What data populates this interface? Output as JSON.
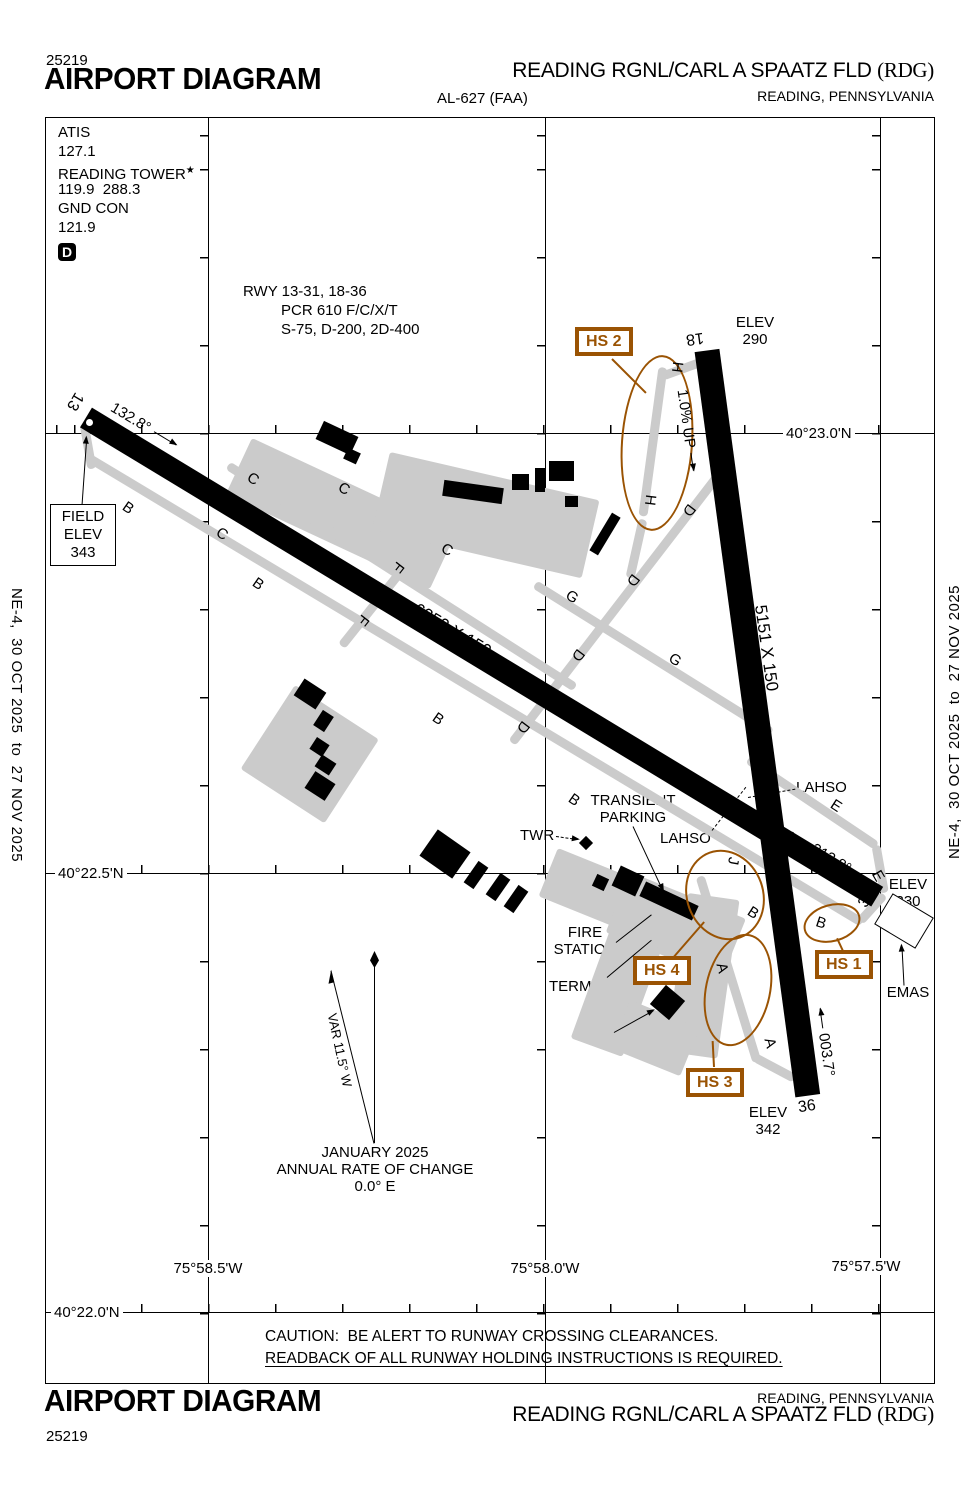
{
  "doc": {
    "chart_number": "25219",
    "title": "AIRPORT DIAGRAM",
    "al_number": "AL-627 (FAA)",
    "airport_name": "READING RGNL/CARL A SPAATZ FLD",
    "airport_code": "(RDG)",
    "city": "READING, PENNSYLVANIA",
    "side_text": "NE-4,  30 OCT 2025  to  27 NOV 2025"
  },
  "comm": {
    "atis_label": "ATIS",
    "atis_freq": "127.1",
    "tower_label": "READING TOWER",
    "tower_star": "★",
    "tower_freq": "119.9  288.3",
    "gnd_label": "GND CON",
    "gnd_freq": "121.9",
    "d_badge": "D"
  },
  "rwy_info": {
    "line1": "RWY 13-31, 18-36",
    "line2": "PCR 610 F/C/X/T",
    "line3": "S-75, D-200, 2D-400"
  },
  "grid": {
    "lat1": "40°23.0'N",
    "lat2": "40°22.5'N",
    "lat3": "40°22.0'N",
    "lon1": "75°58.5'W",
    "lon2": "75°58.0'W",
    "lon3": "75°57.5'W"
  },
  "rwy1331": {
    "num1": "13",
    "num2": "31",
    "dim": "6350 X 150",
    "hdg1": "132.8°",
    "hdg2": "312.8°"
  },
  "rwy1836": {
    "num1": "18",
    "num2": "36",
    "dim": "5151 X 150",
    "hdg1": "183.7°",
    "hdg2": "003.7°",
    "slope": "1.0% UP"
  },
  "elev": {
    "field1": "FIELD",
    "field2": "ELEV",
    "field3": "343",
    "e290_1": "ELEV",
    "e290_2": "290",
    "e330_1": "ELEV",
    "e330_2": "330",
    "e342_1": "ELEV",
    "e342_2": "342",
    "emas": "EMAS"
  },
  "hotspots": {
    "hs1": "HS 1",
    "hs2": "HS 2",
    "hs3": "HS 3",
    "hs4": "HS 4"
  },
  "facilities": {
    "twr": "TWR",
    "transient1": "TRANSIENT",
    "transient2": "PARKING",
    "lahso_left": "LAHSO",
    "lahso_right": "LAHSO",
    "fire1": "FIRE",
    "fire2": "STATION",
    "terminal": "TERMINAL",
    "fbo": "FBO",
    "star": "☆"
  },
  "variation": {
    "var": "VAR 11.5° W",
    "date": "JANUARY 2025",
    "line2": "ANNUAL RATE OF CHANGE",
    "line3": "0.0° E"
  },
  "caution": {
    "line1": "CAUTION:  BE ALERT TO RUNWAY CROSSING CLEARANCES.",
    "line2": "READBACK OF ALL RUNWAY HOLDING INSTRUCTIONS IS REQUIRED."
  },
  "taxiway_labels": [
    {
      "t": "B",
      "x": 128,
      "y": 508,
      "r": 35
    },
    {
      "t": "B",
      "x": 258,
      "y": 584,
      "r": 35
    },
    {
      "t": "B",
      "x": 438,
      "y": 719,
      "r": 35
    },
    {
      "t": "B",
      "x": 574,
      "y": 800,
      "r": 35
    },
    {
      "t": "B",
      "x": 753,
      "y": 913,
      "r": 33
    },
    {
      "t": "B",
      "x": 821,
      "y": 923,
      "r": 18
    },
    {
      "t": "C",
      "x": 253,
      "y": 479,
      "r": 33
    },
    {
      "t": "C",
      "x": 222,
      "y": 534,
      "r": 33
    },
    {
      "t": "C",
      "x": 344,
      "y": 489,
      "r": 28
    },
    {
      "t": "C",
      "x": 447,
      "y": 550,
      "r": 28
    },
    {
      "t": "D",
      "x": 689,
      "y": 510,
      "r": 127
    },
    {
      "t": "D",
      "x": 633,
      "y": 580,
      "r": 127
    },
    {
      "t": "D",
      "x": 578,
      "y": 655,
      "r": 127
    },
    {
      "t": "D",
      "x": 523,
      "y": 727,
      "r": 127
    },
    {
      "t": "E",
      "x": 836,
      "y": 806,
      "r": 33
    },
    {
      "t": "E",
      "x": 878,
      "y": 876,
      "r": 60
    },
    {
      "t": "F",
      "x": 398,
      "y": 567,
      "r": 128
    },
    {
      "t": "F",
      "x": 363,
      "y": 620,
      "r": 128
    },
    {
      "t": "G",
      "x": 572,
      "y": 597,
      "r": 33
    },
    {
      "t": "G",
      "x": 675,
      "y": 660,
      "r": 33
    },
    {
      "t": "H",
      "x": 677,
      "y": 367,
      "r": 97
    },
    {
      "t": "H",
      "x": 650,
      "y": 500,
      "r": 97
    },
    {
      "t": "A",
      "x": 722,
      "y": 968,
      "r": 75
    },
    {
      "t": "A",
      "x": 770,
      "y": 1043,
      "r": 75
    },
    {
      "t": "J",
      "x": 733,
      "y": 861,
      "r": 100
    }
  ]
}
